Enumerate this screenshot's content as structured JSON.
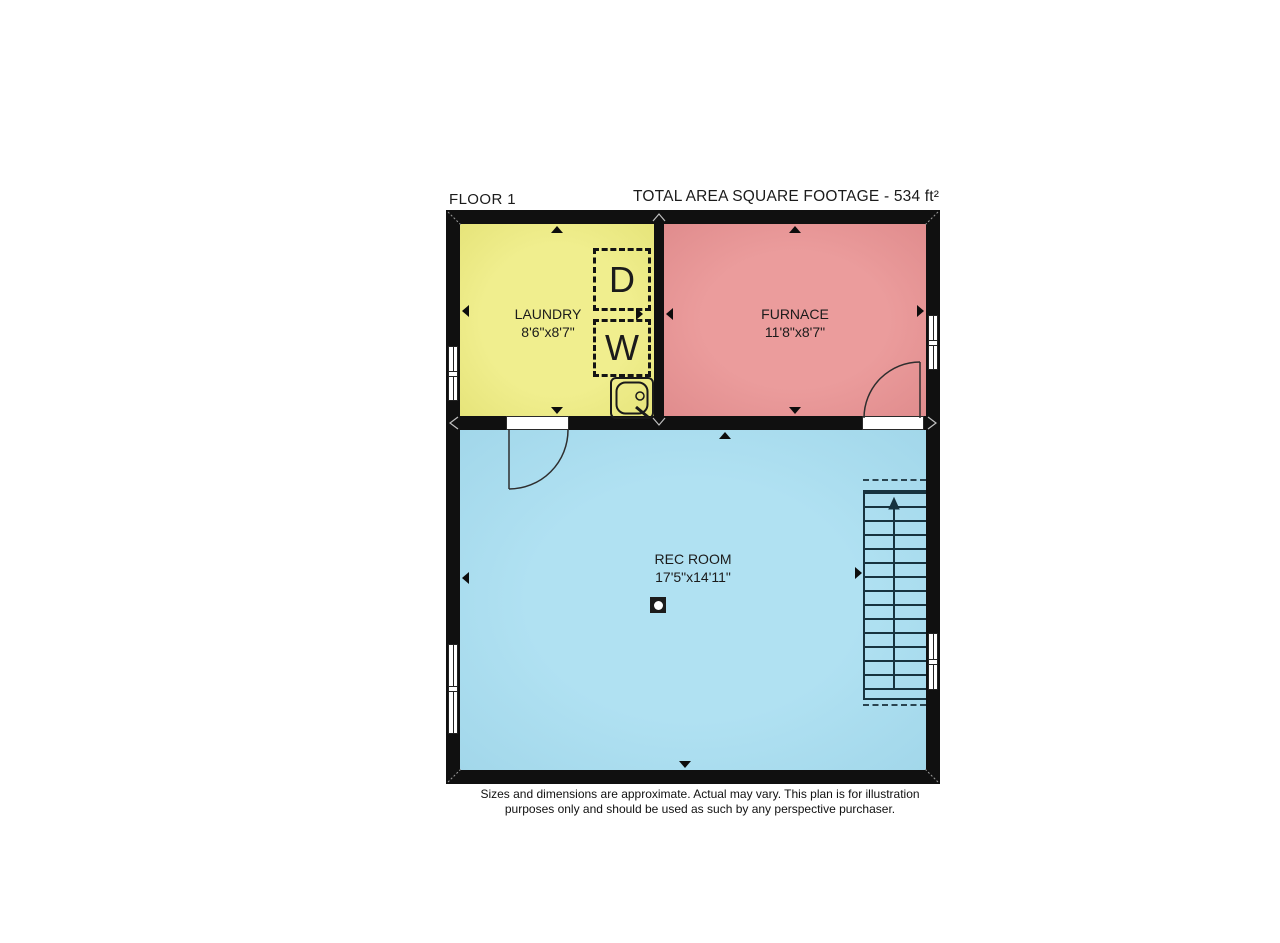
{
  "header": {
    "floor_label": "FLOOR 1",
    "total_area_label": "TOTAL AREA SQUARE FOOTAGE - 534 ft²"
  },
  "rooms": {
    "laundry": {
      "name": "LAUNDRY",
      "dimensions": "8'6\"x8'7\""
    },
    "furnace": {
      "name": "FURNACE",
      "dimensions": "11'8\"x8'7\""
    },
    "rec_room": {
      "name": "REC ROOM",
      "dimensions": "17'5\"x14'11\""
    }
  },
  "appliances": {
    "dryer_label": "D",
    "washer_label": "W"
  },
  "icons": {
    "sink": "utility-sink",
    "stairs": "staircase-going-up",
    "column": "support-column",
    "doors": "door-swing"
  },
  "colors": {
    "wall": "#101010",
    "laundry": "#f0ee8e",
    "furnace": "#e08c8d",
    "rec": "#a2d7ea",
    "stairline": "#17333f",
    "window": "#ffffff"
  },
  "footer": {
    "disclaimer_line1": "Sizes and dimensions are approximate. Actual may vary. This plan is for illustration",
    "disclaimer_line2": "purposes only and should be used as such by any perspective purchaser."
  }
}
